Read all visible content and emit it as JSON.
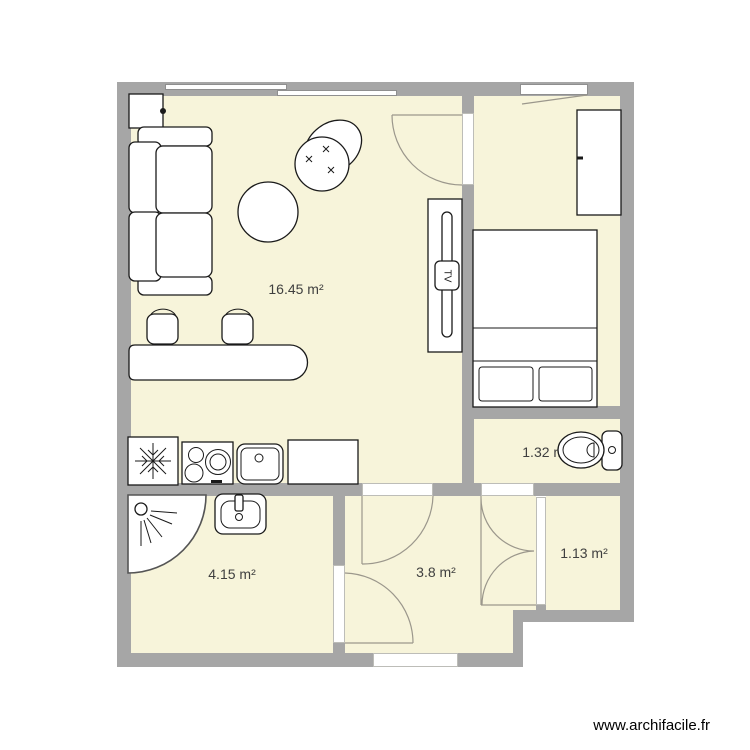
{
  "watermark": "www.archifacile.fr",
  "tv_label": "TV",
  "rooms": [
    {
      "name": "living-room-kitchen",
      "area": "16.45 m²"
    },
    {
      "name": "bedroom",
      "area": "5.85 m²"
    },
    {
      "name": "wc",
      "area": "1.32 m²"
    },
    {
      "name": "bathroom",
      "area": "4.15 m²"
    },
    {
      "name": "hallway",
      "area": "3.8 m²"
    },
    {
      "name": "storage",
      "area": "1.13 m²"
    }
  ],
  "colors": {
    "floor": "#f7f4da",
    "wall": "#a6a6a6",
    "door_line": "#9b978c",
    "furniture_stroke": "#1a1a1a",
    "label_text": "#3f3f3f"
  },
  "furniture": {
    "living_room": [
      "wall-cabinet",
      "sofa",
      "coffee-table",
      "plant",
      "tv-stand",
      "bar-counter",
      "bar-stool",
      "bar-stool",
      "fridge",
      "cooktop",
      "kitchen-sink",
      "kitchen-worktop"
    ],
    "bedroom": [
      "double-bed",
      "wardrobe"
    ],
    "wc": [
      "toilet"
    ],
    "bathroom": [
      "corner-shower",
      "washbasin"
    ]
  }
}
